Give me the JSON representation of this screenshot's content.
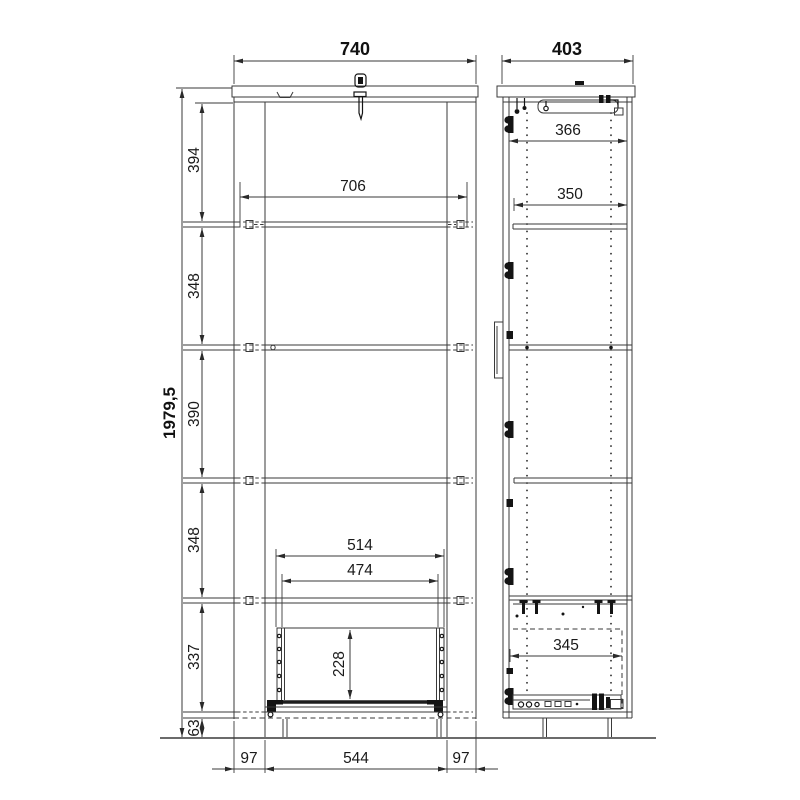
{
  "dimensions": {
    "front": {
      "overall_width": "740",
      "inner_width": "706",
      "overall_height": "1979,5",
      "top_section": "394",
      "section_2": "348",
      "section_3": "390",
      "section_4": "348",
      "section_5": "337",
      "plinth_height": "63",
      "drawer_outer_width": "514",
      "drawer_inner_width": "474",
      "drawer_height": "228",
      "base_inset_left": "97",
      "base_width": "544",
      "base_inset_right": "97"
    },
    "side": {
      "overall_depth": "403",
      "top_shelf_depth": "366",
      "shelf_depth": "350",
      "drawer_depth": "345"
    }
  }
}
